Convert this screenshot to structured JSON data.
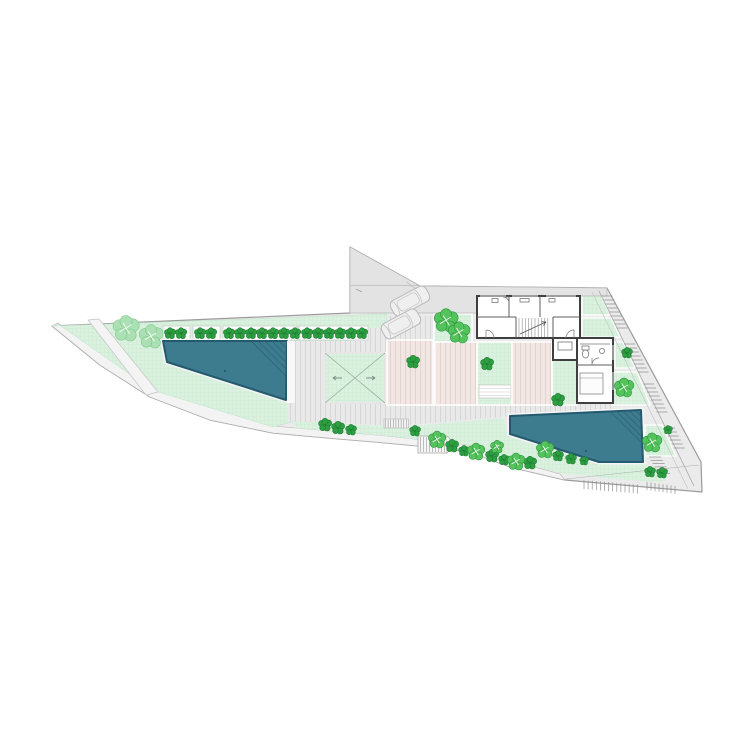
{
  "scene": {
    "kind": "architectural site plan drawing",
    "background": "#ffffff",
    "notes": "wedge-shaped walled site with house, two pools, planted terraces, parking court and stepped boundary paths"
  },
  "colors": {
    "base": "#ebebeb",
    "boundary": "#9b9b9b",
    "lawn": "#d9f1de",
    "lawn_grid": "#c3e7cf",
    "deck": "#e9e9e9",
    "deck_stripe": "#d6d6d6",
    "terrace": "#f2e6e3",
    "terrace_stripe": "#e3d3d0",
    "driveway": "#e3e3e3",
    "pool": "#3d7b8e",
    "pool_edge": "#24596e",
    "pool_coping": "#f5f5f5",
    "wall": "#3f3f3f",
    "shrub": "#2e9e42",
    "shrub_edge": "#1d7c30",
    "leafy": "#55c35b",
    "leafy_edge": "#2c9440",
    "pale_tree": "#abe0b4",
    "pale_tree_edge": "#7ec98b",
    "stair_line": "#8f8f8f",
    "path_white": "#f4f4f4",
    "car_line": "#b9b9b9"
  },
  "counts": {
    "pools": 2,
    "cars": 2,
    "planter_trees": 17
  },
  "drawing": {
    "planter_boxes": [
      [
        163,
        326,
        27,
        14
      ],
      [
        193,
        326,
        27,
        14
      ],
      [
        223,
        326,
        74,
        14
      ],
      [
        299,
        326,
        69,
        14
      ]
    ],
    "planter_trees_x": [
      170,
      181,
      200,
      211,
      229,
      240,
      251,
      262,
      273,
      284,
      295,
      307,
      318,
      329,
      340,
      351,
      362
    ],
    "planter_tree_y": 333.5,
    "planter_tree_r": 5.2,
    "shrubs": [
      [
        413,
        362,
        6
      ],
      [
        487,
        364,
        6
      ],
      [
        558,
        400,
        6
      ],
      [
        627,
        353,
        5
      ],
      [
        325,
        425,
        6
      ],
      [
        338,
        428,
        6
      ],
      [
        351,
        430,
        5
      ],
      [
        415,
        431,
        5
      ],
      [
        452,
        446,
        6
      ],
      [
        464,
        451,
        5
      ],
      [
        492,
        456,
        6
      ],
      [
        504,
        460,
        5
      ],
      [
        530,
        463,
        6
      ],
      [
        558,
        456,
        5
      ],
      [
        571,
        459,
        5
      ],
      [
        584,
        461,
        4
      ],
      [
        650,
        472,
        5
      ],
      [
        662,
        473,
        5
      ],
      [
        668,
        430,
        4
      ]
    ],
    "leafy_trees": [
      [
        446,
        321,
        11
      ],
      [
        459,
        333,
        10
      ],
      [
        624,
        388,
        9
      ],
      [
        652,
        443,
        9
      ],
      [
        437,
        440,
        8
      ],
      [
        476,
        452,
        8
      ],
      [
        516,
        462,
        8
      ],
      [
        545,
        450,
        8
      ],
      [
        497,
        447,
        6
      ]
    ],
    "pale_trees": [
      [
        126,
        329,
        12
      ],
      [
        151,
        337,
        11
      ]
    ],
    "cars": [
      [
        410,
        301,
        -28
      ],
      [
        401,
        324,
        -28
      ]
    ],
    "east_steps": {
      "y_start": 296,
      "y_end": 448,
      "step": 4,
      "x0": 599,
      "y0": 291,
      "slope": 0.475,
      "tread_len": 11,
      "landings": [
        [
          330,
          341
        ],
        [
          372,
          383
        ],
        [
          414,
          425
        ]
      ]
    },
    "bottom_steps_a": {
      "x0": 584,
      "y0": 480,
      "n": 14,
      "dx": 4.1,
      "dy": 0.35,
      "len": 9
    },
    "bottom_steps_b": {
      "x0": 647,
      "y0": 482,
      "n": 8,
      "dx": 4.0,
      "dy": 0.55,
      "len": 8
    },
    "flight_c": {
      "y_start": 457,
      "y_end": 476,
      "step": 3.3,
      "x0": 649,
      "slope": 0.55,
      "len": 12
    }
  }
}
